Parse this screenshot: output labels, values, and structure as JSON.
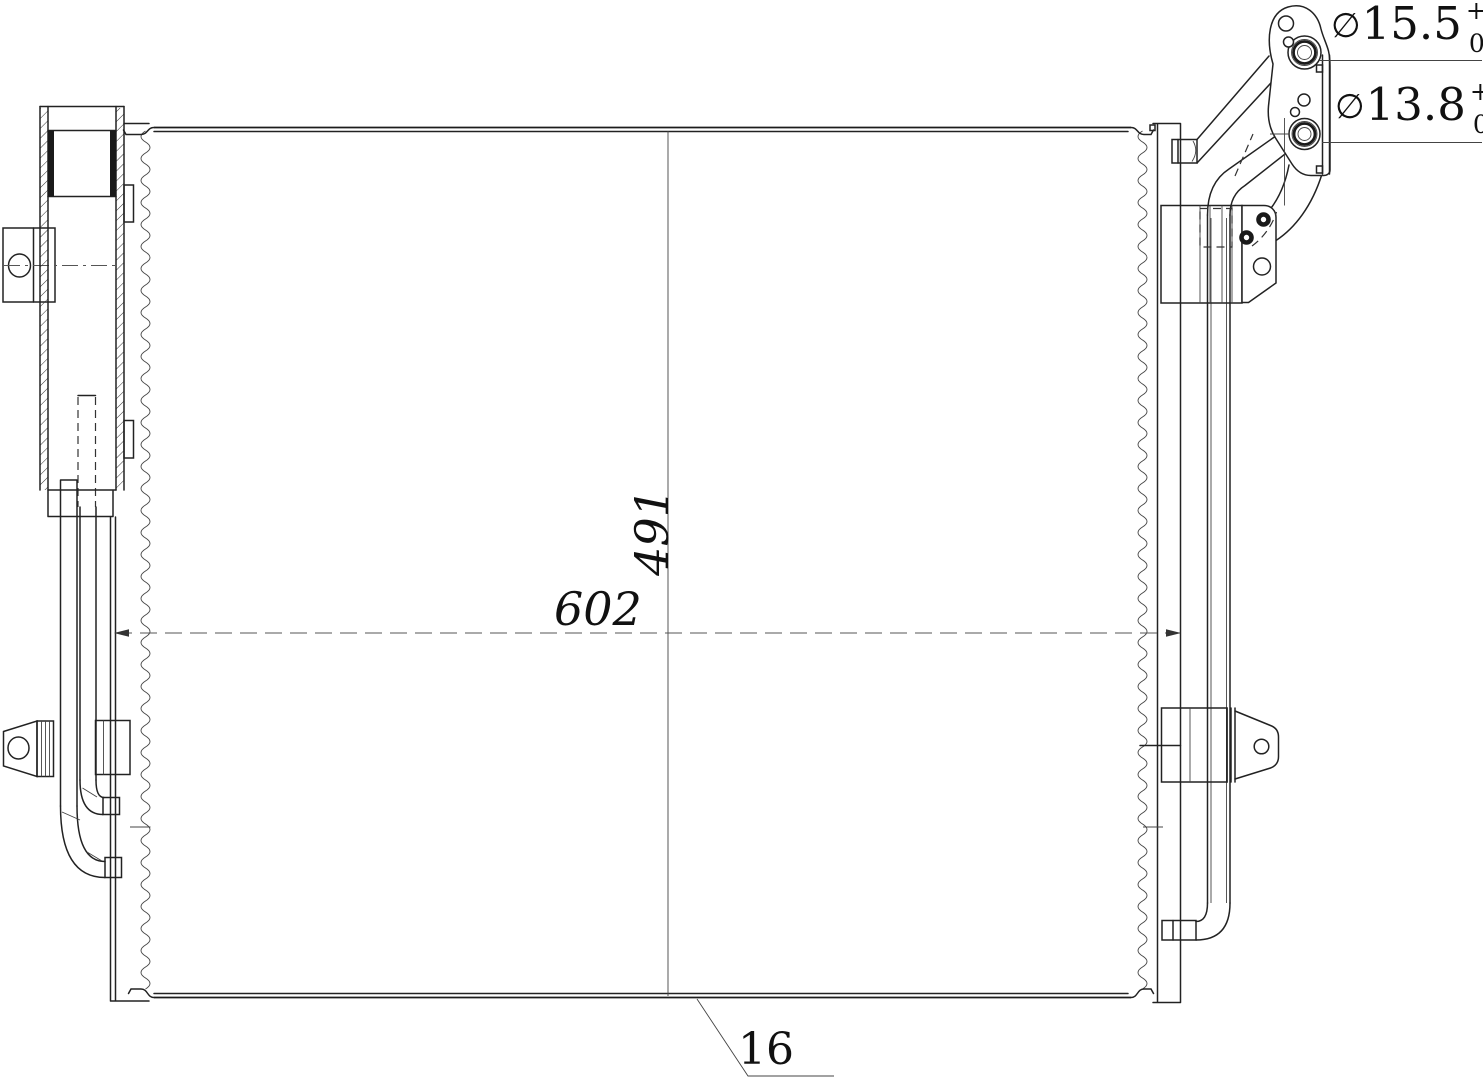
{
  "drawing": {
    "port_top_callout": {
      "symbol": "∅",
      "value": "15.5",
      "tolerance_upper": "+0.05",
      "tolerance_lower": "0"
    },
    "port_bottom_callout": {
      "symbol": "∅",
      "value": "13.8",
      "tolerance_upper": "+0.05",
      "tolerance_lower": "0"
    },
    "core_width_dim": "602",
    "core_height_dim": "491",
    "core_thickness_dim": "16"
  },
  "colors": {
    "line": "#1f1f1f",
    "background": "#ffffff"
  }
}
